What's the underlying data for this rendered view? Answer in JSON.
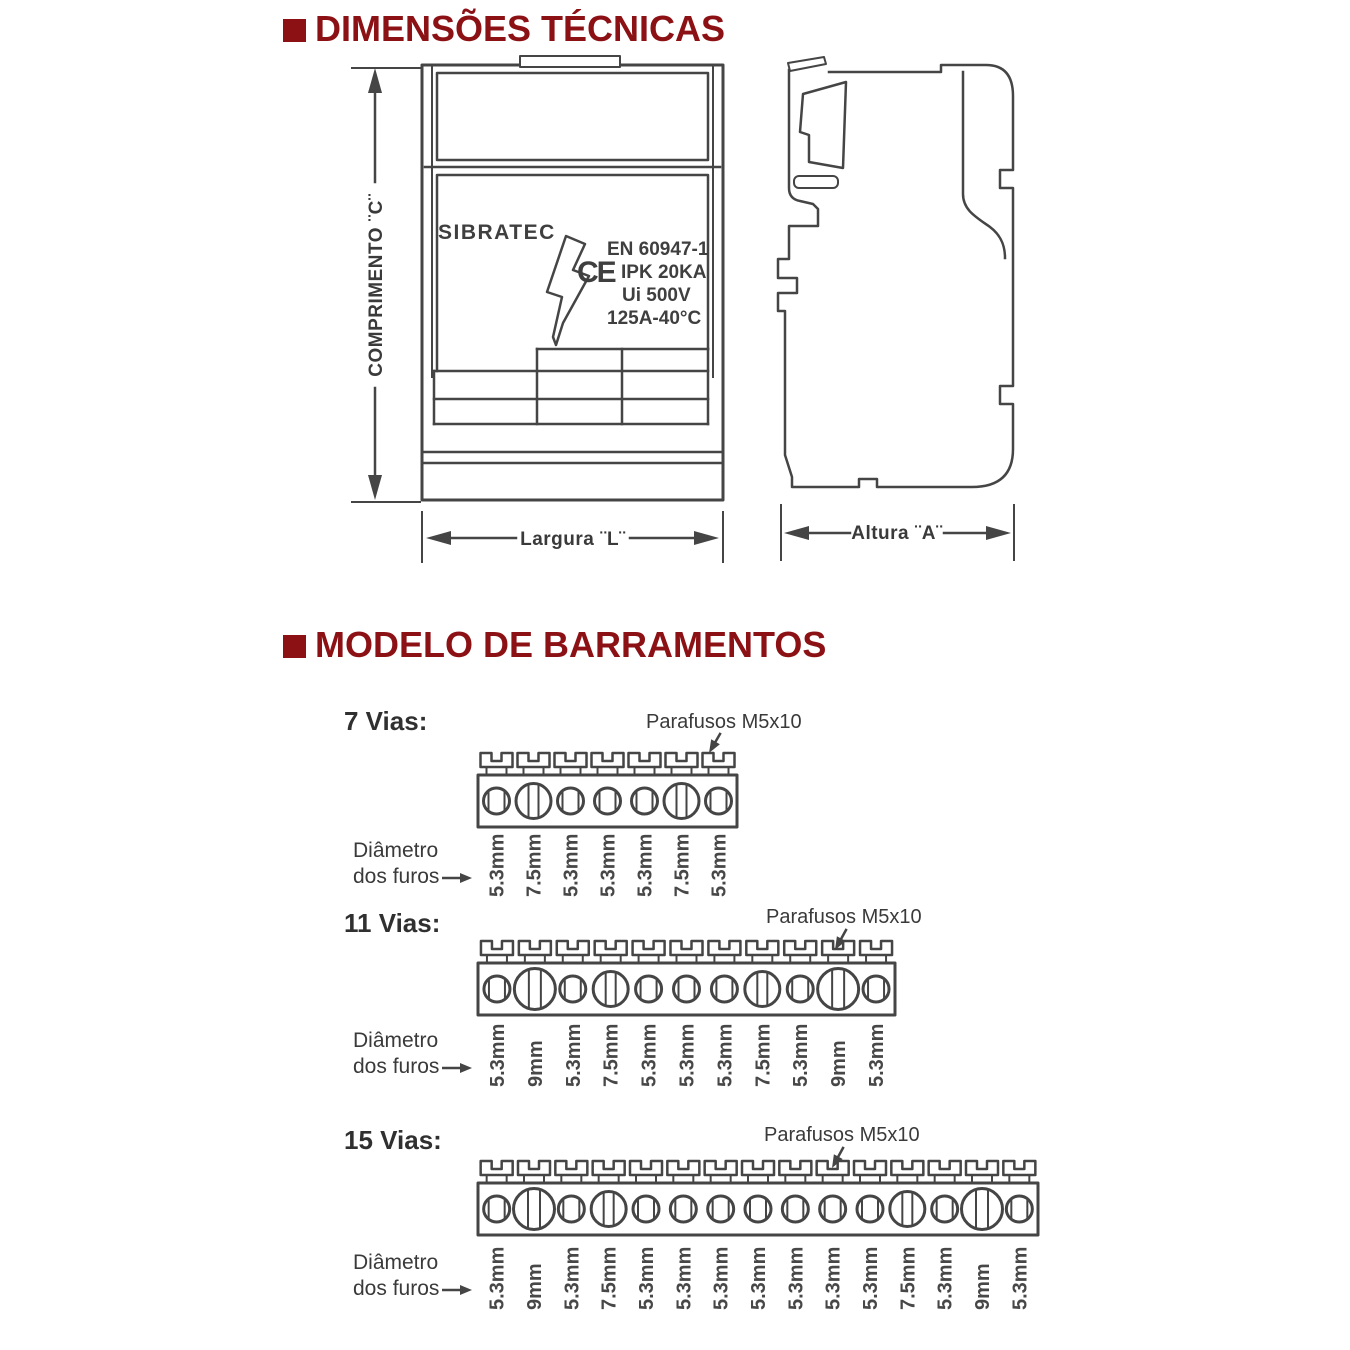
{
  "colors": {
    "title_red": "#8c1115",
    "line_gray": "#454545",
    "text_gray": "#3a3a3a"
  },
  "dimensions_section": {
    "title": "DIMENSÕES TÉCNICAS",
    "front_view": {
      "logo": "SIBRATEC",
      "ce_mark": "CE",
      "cert_lines": [
        "EN 60947-1",
        "IPK 20KA",
        "Ui 500V",
        "125A-40°C"
      ],
      "dim_length_label": "COMPRIMENTO ¨C¨",
      "dim_width_label": "Largura ¨L¨"
    },
    "side_view": {
      "dim_height_label": "Altura ¨A¨"
    }
  },
  "barramentos_section": {
    "title": "MODELO DE BARRAMENTOS",
    "screws_label": "Parafusos M5x10",
    "diameter_caption_line1": "Diâmetro",
    "diameter_caption_line2": "dos furos",
    "models": [
      {
        "label": "7 Vias:",
        "holes": [
          "5.3mm",
          "7.5mm",
          "5.3mm",
          "5.3mm",
          "5.3mm",
          "7.5mm",
          "5.3mm"
        ]
      },
      {
        "label": "11 Vias:",
        "holes": [
          "5.3mm",
          "9mm",
          "5.3mm",
          "7.5mm",
          "5.3mm",
          "5.3mm",
          "5.3mm",
          "7.5mm",
          "5.3mm",
          "9mm",
          "5.3mm"
        ]
      },
      {
        "label": "15 Vias:",
        "holes": [
          "5.3mm",
          "9mm",
          "5.3mm",
          "7.5mm",
          "5.3mm",
          "5.3mm",
          "5.3mm",
          "5.3mm",
          "5.3mm",
          "5.3mm",
          "5.3mm",
          "7.5mm",
          "5.3mm",
          "9mm",
          "5.3mm"
        ]
      }
    ]
  }
}
